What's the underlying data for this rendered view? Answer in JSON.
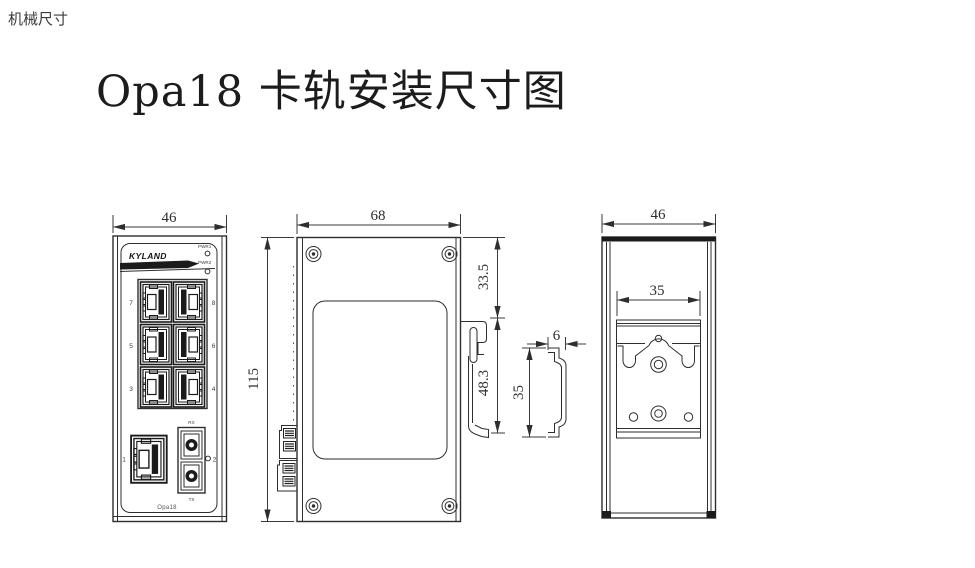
{
  "page": {
    "header": "机械尺寸",
    "title": "Opa18 卡轨安装尺寸图"
  },
  "front_view": {
    "dim_width": "46",
    "logo": "KYLAND",
    "led1": "PWR1",
    "led2": "PWR2",
    "port7": "7",
    "port8": "8",
    "port5": "5",
    "port6": "6",
    "port3": "3",
    "port4": "4",
    "port1": "1",
    "port2": "2",
    "fiber_rx": "RX",
    "fiber_tx": "TX",
    "model": "Opa18"
  },
  "side_view": {
    "dim_width": "68",
    "dim_height": "115",
    "dim_rail_top": "33.5",
    "dim_clip": "48.3"
  },
  "rail_profile": {
    "dim_depth": "6",
    "dim_height": "35"
  },
  "back_view": {
    "dim_width": "46",
    "dim_clip_width": "35"
  },
  "colors": {
    "line": "#2e2e2e",
    "dark_fill": "#1b1b1b",
    "background": "#ffffff"
  }
}
